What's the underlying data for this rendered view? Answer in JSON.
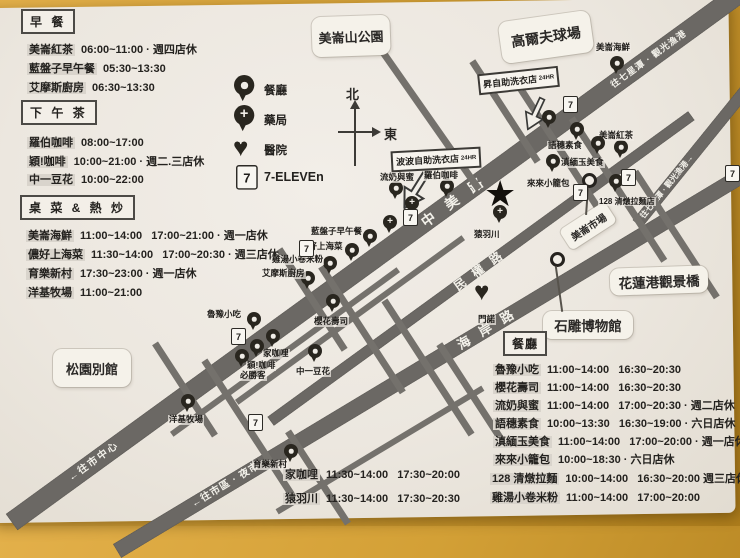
{
  "icons": {
    "plus": "+",
    "heart": "♥",
    "star": "★",
    "seven": "7",
    "north_arrow": "↑",
    "east_arrow": "→"
  },
  "sections": {
    "breakfast": {
      "header": "早 餐",
      "items": [
        {
          "name": "美崙紅茶",
          "hours": "06:00~11:00 · 週四店休"
        },
        {
          "name": "藍盤子早午餐",
          "hours": "05:30~13:30"
        },
        {
          "name": "艾摩斯廚房",
          "hours": "06:30~13:30"
        }
      ]
    },
    "afternoon_tea": {
      "header": "下 午 茶",
      "items": [
        {
          "name": "羅伯咖啡",
          "hours": "08:00~17:00"
        },
        {
          "name": "穎!咖啡",
          "hours": "10:00~21:00 · 週二.三店休"
        },
        {
          "name": "中一豆花",
          "hours": "10:00~22:00"
        }
      ]
    },
    "banquet": {
      "header": "桌 菜 & 熱 炒",
      "items": [
        {
          "name": "美崙海鮮",
          "hours": "11:00~14:00   17:00~21:00 · 週一店休"
        },
        {
          "name": "儂好上海菜",
          "hours": "11:30~14:00   17:00~20:30 · 週三店休"
        },
        {
          "name": "育樂新村",
          "hours": "17:30~23:00 · 週一店休"
        },
        {
          "name": "洋基牧場",
          "hours": "11:00~21:00"
        }
      ]
    },
    "restaurants": {
      "header": "餐廳",
      "items": [
        {
          "name": "魯豫小吃",
          "hours": "11:00~14:00   16:30~20:30"
        },
        {
          "name": "櫻花壽司",
          "hours": "11:00~14:00   16:30~20:30"
        },
        {
          "name": "流奶與蜜",
          "hours": "11:00~14:00   17:00~20:30 · 週二店休"
        },
        {
          "name": "語穗素食",
          "hours": "10:00~13:30   16:30~19:00 · 六日店休"
        },
        {
          "name": "滇緬玉美食",
          "hours": "11:00~14:00   17:00~20:00 · 週一店休"
        },
        {
          "name": "來來小籠包",
          "hours": "10:00~18:30 · 六日店休"
        },
        {
          "name": "128 清燉拉麵",
          "hours": "10:00~14:00   16:30~20:00 週三店休"
        },
        {
          "name": "雞湯小卷米粉",
          "hours": "11:00~14:00   17:00~20:00"
        }
      ]
    },
    "extra": {
      "items": [
        {
          "name": "家咖哩",
          "hours": "11:30~14:00   17:30~20:00"
        },
        {
          "name": "猿羽川",
          "hours": "11:30~14:00   17:30~20:30"
        }
      ]
    }
  },
  "legend": {
    "restaurant": "餐廳",
    "pharmacy": "藥局",
    "hospital": "醫院",
    "seven": "7-ELEVEn"
  },
  "compass": {
    "north": "北",
    "east": "東"
  },
  "map": {
    "areas": {
      "park": "美崙山公園",
      "golf": "高爾夫球場",
      "pine": "松園別館",
      "museum": "石雕博物館",
      "bridge": "花蓮港觀景橋",
      "market": "美崙市場"
    },
    "laundry": {
      "sheng": "昇自助洗衣店",
      "popo": "波波自助洗衣店",
      "hours": "24HR"
    },
    "roads": {
      "zhongmei": "中美路",
      "minquan": "民權路",
      "haian": "海岸路",
      "qixingtan": "往七星潭 · 觀光漁港",
      "qixingtan2": "往七星潭 · 觀光漁港→",
      "city_center": "←往市中心",
      "night_market": "←往市區 · 夜市"
    },
    "pois": [
      {
        "label": "美崙海鮮"
      },
      {
        "label": "美崙紅茶"
      },
      {
        "label": "語穗素食"
      },
      {
        "label": "滇緬玉美食"
      },
      {
        "label": "來來小籠包"
      },
      {
        "label": "128 清燉拉麵店"
      },
      {
        "label": "流奶與蜜"
      },
      {
        "label": "羅伯咖啡"
      },
      {
        "label": "藍盤子早午餐"
      },
      {
        "label": "儂好上海菜"
      },
      {
        "label": "雞湯小卷米粉"
      },
      {
        "label": "艾摩斯廚房"
      },
      {
        "label": "魯豫小吃"
      },
      {
        "label": "家咖哩"
      },
      {
        "label": "穎!咖啡"
      },
      {
        "label": "必勝客"
      },
      {
        "label": "中一豆花"
      },
      {
        "label": "櫻花壽司"
      },
      {
        "label": "洋基牧場"
      },
      {
        "label": "育樂新村"
      },
      {
        "label": "猿羽川"
      },
      {
        "label": "門諾"
      }
    ]
  }
}
